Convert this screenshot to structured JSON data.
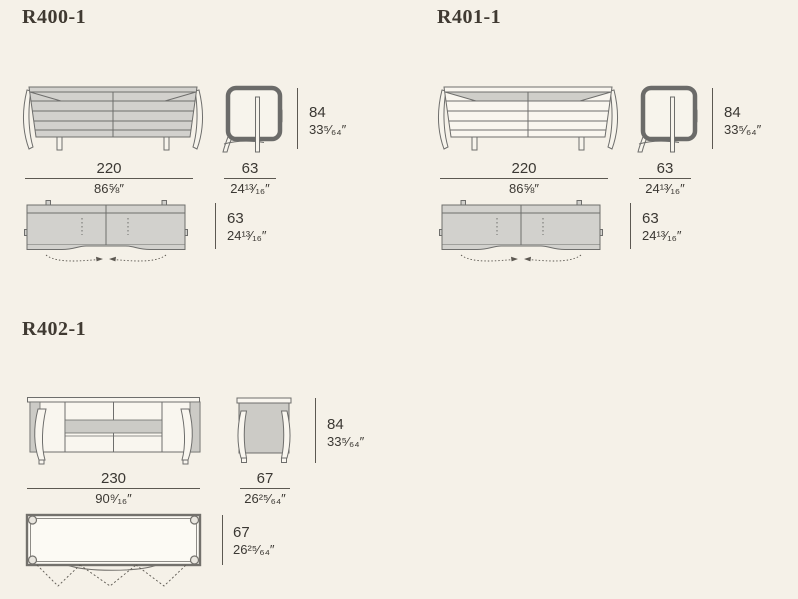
{
  "sheet": {
    "type": "furniture dimension sheet",
    "background": "#f5f1e8"
  },
  "colors": {
    "background": "#f5f1e8",
    "drawing_line": "#6e6e6c",
    "drawing_fill_gray": "#d2d1cd",
    "drawing_fill_light": "#f9f6ef",
    "dim_line": "#5c5851",
    "text": "#3b3833",
    "title_text": "#403a32"
  },
  "models": [
    {
      "title": "R400-1",
      "front": {
        "width_cm": "220",
        "width_in": "86⅝″"
      },
      "side": {
        "depth_cm": "63",
        "depth_in": "24¹³⁄₁₆″"
      },
      "height": {
        "cm": "84",
        "in": "33⁵⁄₆₄″"
      },
      "top": {
        "depth_cm": "63",
        "depth_in": "24¹³⁄₁₆″"
      }
    },
    {
      "title": "R401-1",
      "front": {
        "width_cm": "220",
        "width_in": "86⅝″"
      },
      "side": {
        "depth_cm": "63",
        "depth_in": "24¹³⁄₁₆″"
      },
      "height": {
        "cm": "84",
        "in": "33⁵⁄₆₄″"
      },
      "top": {
        "depth_cm": "63",
        "depth_in": "24¹³⁄₁₆″"
      }
    },
    {
      "title": "R402-1",
      "front": {
        "width_cm": "230",
        "width_in": "90⁹⁄₁₆″"
      },
      "side": {
        "depth_cm": "67",
        "depth_in": "26²⁵⁄₆₄″"
      },
      "height": {
        "cm": "84",
        "in": "33⁵⁄₆₄″"
      },
      "top": {
        "depth_cm": "67",
        "depth_in": "26²⁵⁄₆₄″"
      }
    }
  ]
}
